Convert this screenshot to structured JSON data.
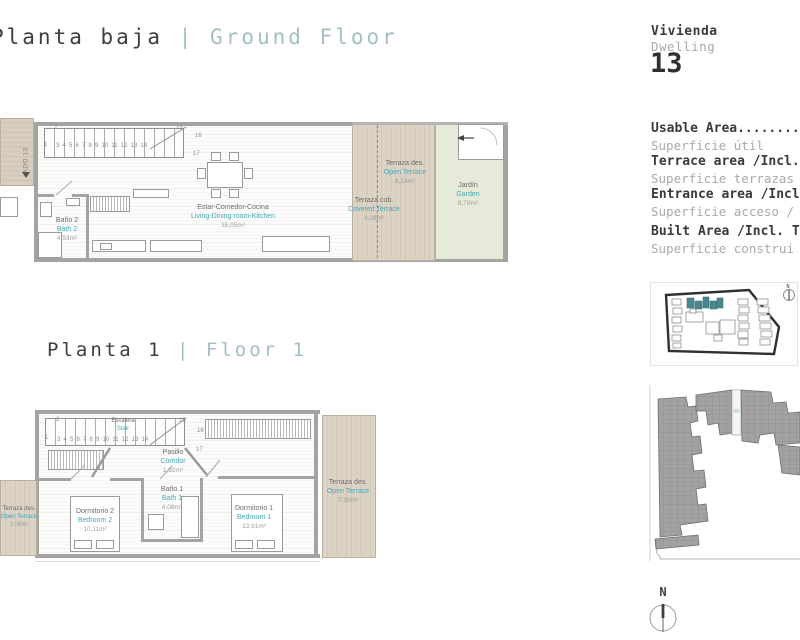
{
  "titles": {
    "ground": {
      "es": "Planta baja",
      "divider": "|",
      "en": "Ground Floor"
    },
    "first": {
      "es": "Planta 1",
      "divider": "|",
      "en": "Floor 1"
    }
  },
  "sidebar": {
    "dwelling_es": "Vivienda",
    "dwelling_en": "Dwelling",
    "dwelling_number": "13",
    "areas": [
      {
        "en": "Usable Area...........",
        "es": "Superficie útil"
      },
      {
        "en": "Terrace area /Incl. ",
        "es": "Superficie terrazas"
      },
      {
        "en": "Entrance area /Incl",
        "es": "Superficie acceso /"
      },
      {
        "en": "Built Area /Incl. T",
        "es": "Superficie construi"
      }
    ]
  },
  "compass": {
    "n": "N"
  },
  "ground_floor": {
    "entry_code": "ADO 13",
    "stair": {
      "n1": "1",
      "n2": "2",
      "row": "3 4 5 6 7 8 9 10 11 12 13 14",
      "n15": "15",
      "n16": "16",
      "n17": "17"
    },
    "bath2": {
      "es": "Baño 2",
      "en": "Bath 2",
      "area": "4,53m²"
    },
    "living": {
      "es": "Estar-Comedor-Cocina",
      "en": "Living-Dining room-Kitchen",
      "area": "35,05m²"
    },
    "open_terrace": {
      "es": "Terraza des.",
      "en": "Open Terrace",
      "area": "8,14m²"
    },
    "covered_terrace": {
      "es": "Terraza cub.",
      "en": "Covered Terrace",
      "area": "3,08m²"
    },
    "garden": {
      "es": "Jardín",
      "en": "Garden",
      "area": "8,79m²"
    }
  },
  "first_floor": {
    "stair": {
      "es": "Escalera",
      "en": "Stair",
      "n1": "1",
      "n2": "2",
      "row": "3 4 5 6 7 8 9 10 11 12 13 14",
      "n15": "15",
      "n16": "16",
      "n17": "17"
    },
    "corridor": {
      "es": "Pasillo",
      "en": "Corridor",
      "area": "1,92m²"
    },
    "bath1": {
      "es": "Baño 1",
      "en": "Bath 1",
      "area": "4,08m²"
    },
    "bedroom2": {
      "es": "Dormitorio 2",
      "en": "Bedroom 2",
      "area": "10,11m²"
    },
    "bedroom1": {
      "es": "Dormitorio 1",
      "en": "Bedroom 1",
      "area": "13,91m²"
    },
    "terrace_left": {
      "es": "Terraza des.",
      "en": "Open Terrace",
      "area": "3,08m²"
    },
    "terrace_right": {
      "es": "Terraza des.",
      "en": "Open Terrace",
      "area": "7,30m²"
    }
  }
}
